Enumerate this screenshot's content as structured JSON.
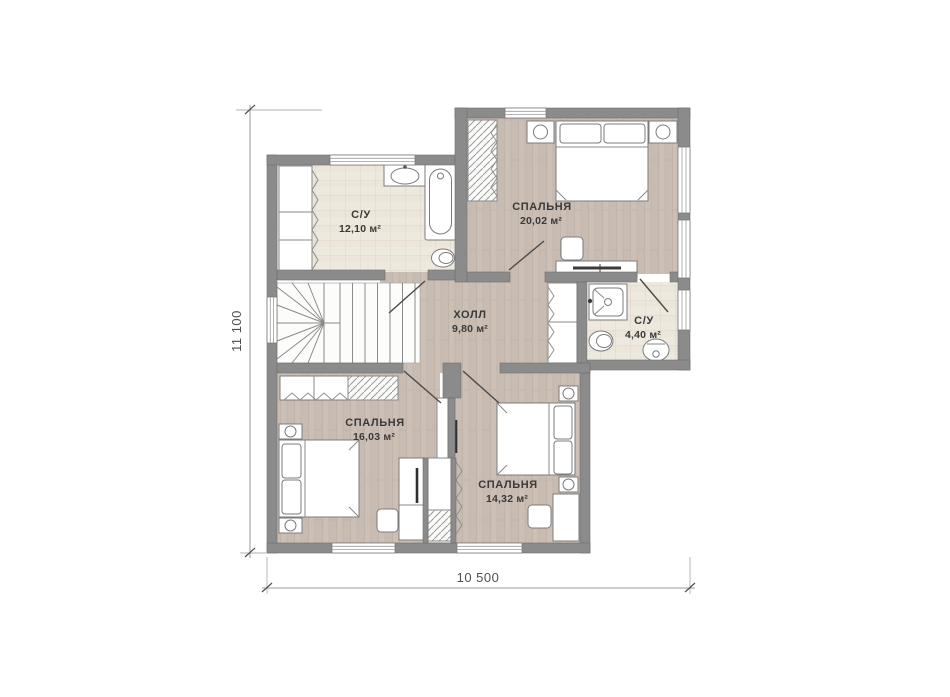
{
  "plan": {
    "type": "floor-plan",
    "rooms": [
      {
        "name": "С/У",
        "area": "12,10 м²"
      },
      {
        "name": "СПАЛЬНЯ",
        "area": "20,02 м²"
      },
      {
        "name": "ХОЛЛ",
        "area": "9,80 м²"
      },
      {
        "name": "С/У",
        "area": "4,40 м²"
      },
      {
        "name": "СПАЛЬНЯ",
        "area": "16,03 м²"
      },
      {
        "name": "СПАЛЬНЯ",
        "area": "14,32 м²"
      }
    ],
    "dimensions": {
      "height": "11 100",
      "width": "10 500"
    },
    "depicted_fixtures": [
      "stairs",
      "bathtub",
      "sink",
      "toilet",
      "shower",
      "double-bed",
      "single-bed",
      "nightstand-lamp",
      "wardrobe",
      "desk",
      "chair",
      "window",
      "door"
    ],
    "colors": {
      "wall": "#8b8b8b",
      "wood_floor": "#c8bbb1",
      "tile_floor": "#eee9df",
      "outline": "#6f6f6f",
      "label_text": "#3a3a3a",
      "dimension_text": "#4f4f4f"
    }
  }
}
